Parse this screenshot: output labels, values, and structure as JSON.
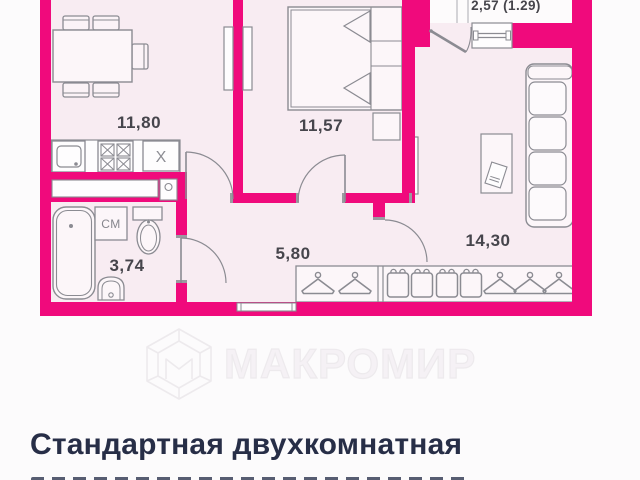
{
  "floor_plan": {
    "rooms": [
      {
        "id": "kitchen",
        "area_label": "11,80"
      },
      {
        "id": "bedroom",
        "area_label": "11,57"
      },
      {
        "id": "living_room",
        "area_label": "14,30"
      },
      {
        "id": "hallway",
        "area_label": "5,80"
      },
      {
        "id": "bathroom",
        "area_label": "3,74"
      },
      {
        "id": "balcony",
        "area_label": "2,57 (1.29)"
      }
    ],
    "fixture_marks": {
      "washing_machine": "СМ",
      "appliance_spot": "X"
    },
    "colors": {
      "wall": "#f00a7c",
      "floor": "#f8ecf2",
      "outline": "#8b8b92",
      "background": "#fcfbfc"
    }
  },
  "watermark": {
    "text": "МАКРОМИР",
    "logo": "hex-cube-logo"
  },
  "caption": {
    "title": "Стандартная двухкомнатная"
  }
}
